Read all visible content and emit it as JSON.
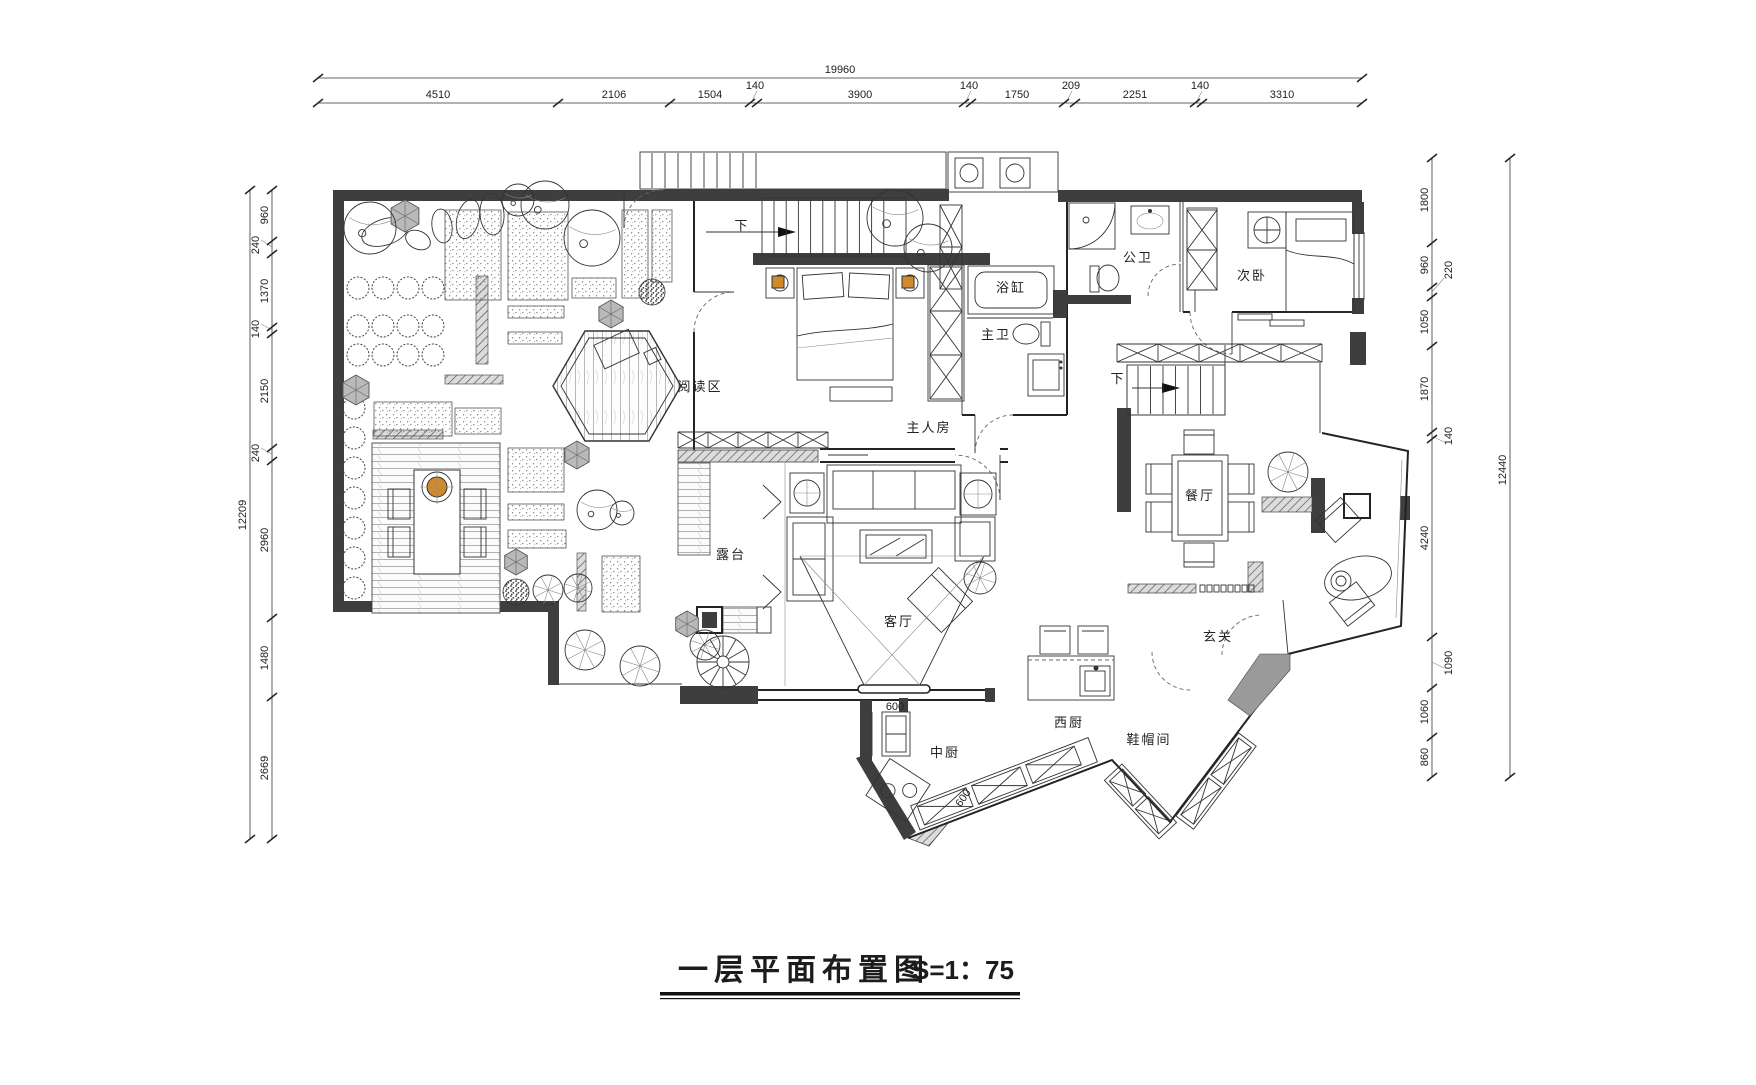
{
  "title": {
    "text": "一层平面布置图",
    "scale": "S=1：75"
  },
  "stair_label": "下",
  "inline_dims": {
    "kitchen_opening": "600",
    "kitchen_counter": "600"
  },
  "rooms": {
    "reading_area": "阅读区",
    "master_bedroom": "主人房",
    "bathtub": "浴缸",
    "master_bath": "主卫",
    "guest_bath": "公卫",
    "second_bedroom": "次卧",
    "dining_room": "餐厅",
    "terrace": "露台",
    "living_room": "客厅",
    "foyer": "玄关",
    "chinese_kitchen": "中厨",
    "western_kitchen": "西厨",
    "cloakroom": "鞋帽间"
  },
  "dims": {
    "top": {
      "total": "19960",
      "segments": [
        "4510",
        "2106",
        "1504",
        "140",
        "3900",
        "140",
        "1750",
        "209",
        "2251",
        "140",
        "3310"
      ]
    },
    "left": {
      "total": "12209",
      "segments": [
        "960",
        "240",
        "1370",
        "140",
        "2150",
        "240",
        "2960",
        "1480",
        "2669"
      ]
    },
    "right": {
      "total": "12440",
      "segments": [
        "1800",
        "960",
        "1050",
        "1870",
        "4240",
        "1060",
        "860"
      ],
      "sub_segments": [
        "220",
        "140",
        "1090"
      ]
    }
  },
  "colors": {
    "paper": "#ffffff",
    "line": "#2a2a2a",
    "wall": "#3e3e3e",
    "mid_gray": "#9a9a9a",
    "light_gray": "#bdbdbd",
    "accent_orange": "#d08a2e"
  }
}
